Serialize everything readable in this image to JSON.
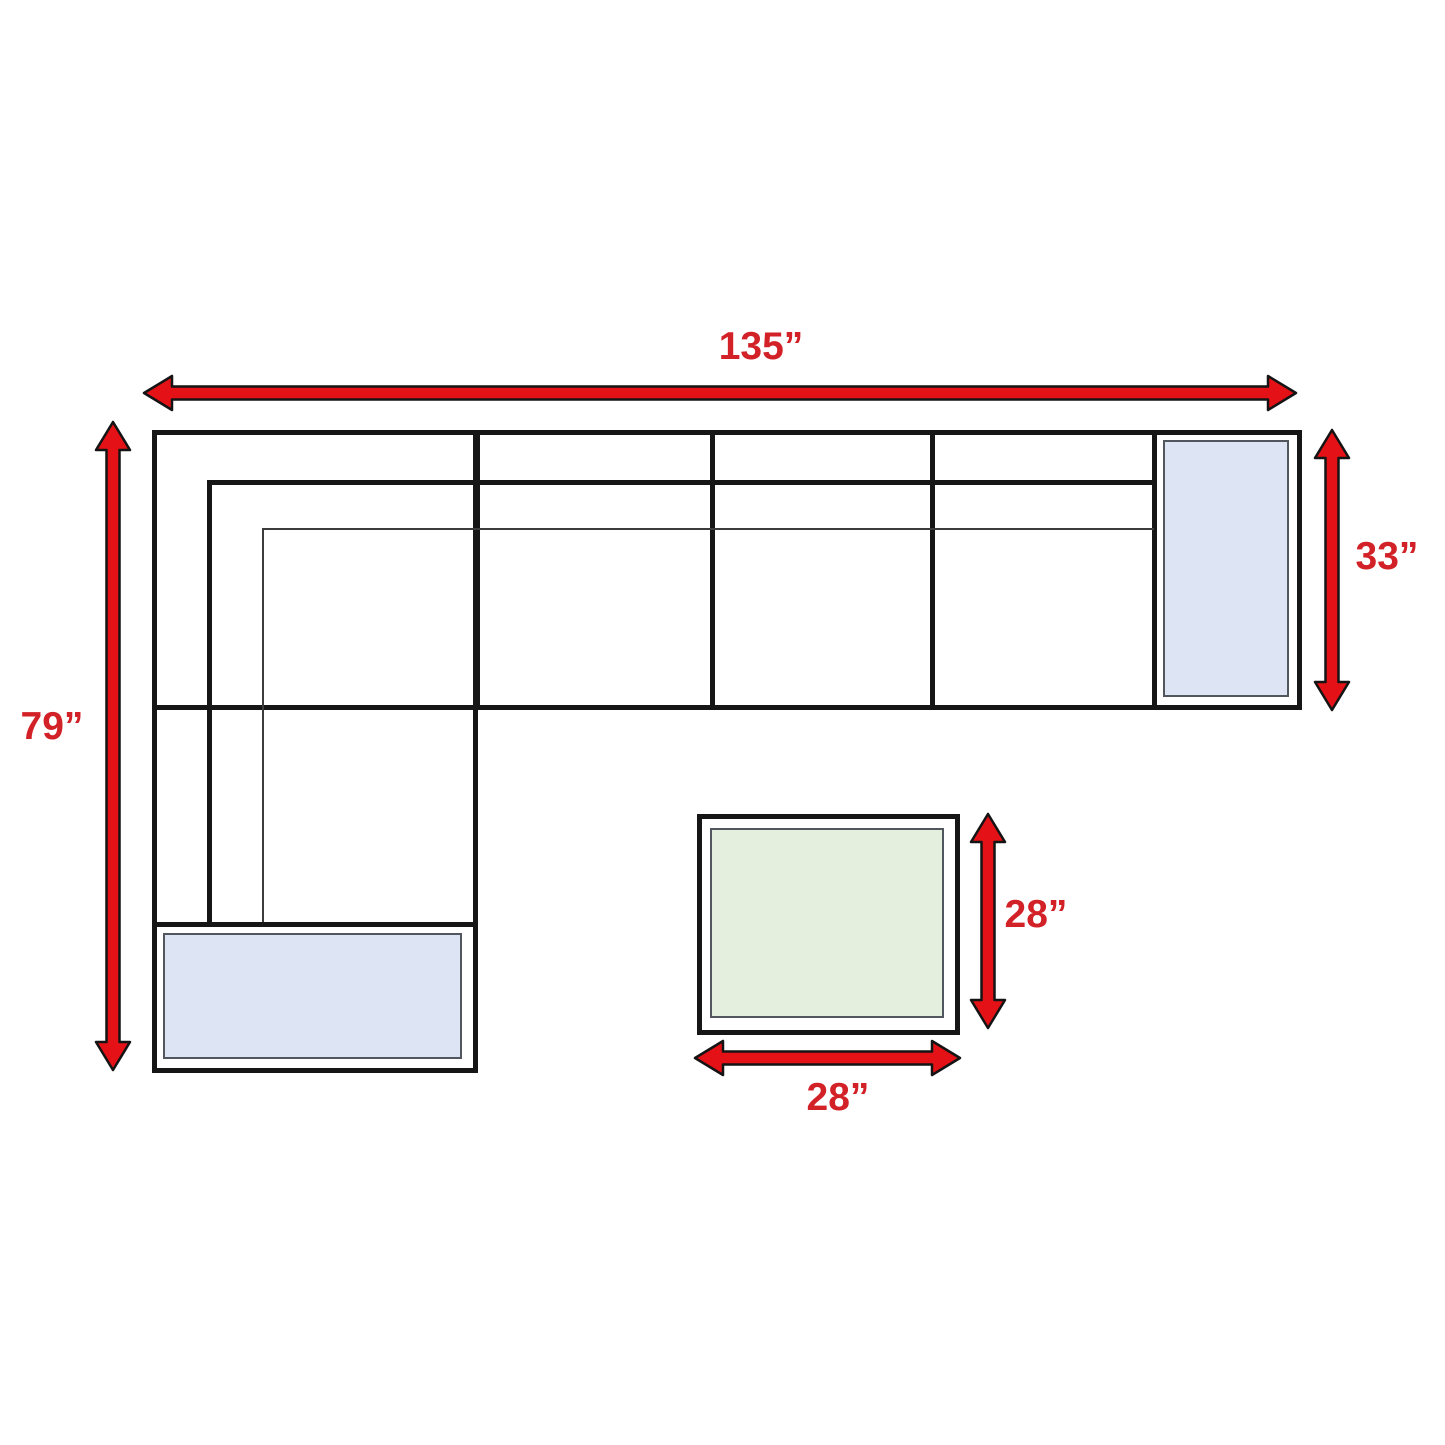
{
  "diagram": {
    "name": "sectional-sofa-dimension-diagram",
    "dimensions": {
      "sofa_width": "135”",
      "sofa_depth": "79”",
      "right_end_depth": "33”",
      "ottoman_depth": "28”",
      "ottoman_width": "28”"
    },
    "colors": {
      "arrow": "#e41117",
      "label": "#d22127",
      "outline": "#161616",
      "pillow_blue": "#dde4f4",
      "ottoman_green": "#e5efde"
    }
  }
}
